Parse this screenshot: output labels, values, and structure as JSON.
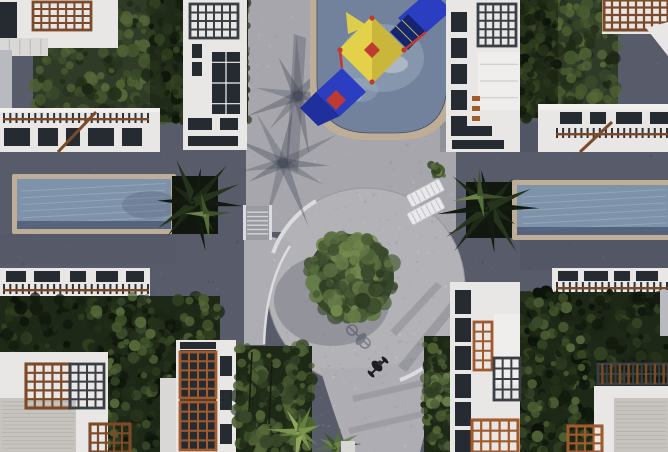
{
  "scene": {
    "title": "Aerial top-down 3D render of a residential complex courtyard",
    "view": "top-down",
    "landmarks": [
      "kids pool with playground slide",
      "left lap pool",
      "right lap pool",
      "central circular plaza",
      "round courtyard tree",
      "curved pedestrian path",
      "cyclist on path",
      "white apartment buildings with wooden pergolas",
      "green hedges, gardens and palm trees",
      "lounge chairs and stairs at pool deck"
    ]
  },
  "colors": {
    "paving_dark": "#585c6a",
    "walkway_light": "#a6a6ac",
    "plaza_light": "#b3b2b6",
    "path_light": "#aeadb3",
    "curb_white": "#dcdbdd",
    "stair_tread": "#9a9aa2",
    "step_line": "#b9b8b6",
    "plaza_rim": "#97979f",
    "shadow_blue": "#3e4354",
    "pool_water": "#7e92aa",
    "kids_pool_water": "#73829c",
    "pool_border_tan": "#bfae97",
    "pool_edge_shadow": "#46506a",
    "ripple_light": "#aabdce",
    "planter_dark": "#11160f",
    "building_white": "#e8e7e5",
    "building_dim": "#d9d8d6",
    "roof_light": "#f1f0ee",
    "roof_concrete": "#c7c4c0",
    "roof_grain": "#8f8c88",
    "wall_gray": "#b9bac0",
    "court_white": "#efeeec",
    "window_dark": "#262b31",
    "window_frame": "#eef0f2",
    "pergola_brown": "#7c4a28",
    "pergola_orange": "#a05a2c",
    "pergola_dark": "#3a3e45",
    "fence_dark": "#2e3236",
    "hedge_top_base": "#2f3b26",
    "hedge_dark_base": "#1e2817",
    "hedge_shade": "#101708",
    "tree_base": "#36452a",
    "trunk_dark": "#151b10",
    "grid_rail_gray": "#9aa0a8",
    "canopy_yellow": "#e3d149",
    "canopy_shade": "#c9b63a",
    "slide_blue": "#2b3dc0",
    "slide_blue_dark": "#202f9e",
    "net_navy": "#15246e",
    "net_line": "#d8d84e",
    "frame_red": "#bf3a30",
    "splash_white": "#cfd8e2",
    "chair_white": "#e9e9eb",
    "chair_slat": "#bfbfc6",
    "pot_white": "#d8d7d5",
    "bike_dark": "#1d1d22",
    "bush_green": "#4a5c31",
    "palettes": {
      "noisePaving": [
        "rgba(255,255,255,0.05)",
        "rgba(0,0,0,0.09)",
        "rgba(185,195,212,0.06)"
      ],
      "noiseLight": [
        "rgba(70,74,88,0.10)",
        "rgba(255,255,255,0.12)",
        "rgba(120,120,135,0.08)"
      ],
      "hedge": [
        "#243019",
        "#38482a",
        "#46592f",
        "#56683a",
        "#1c2614",
        "#4f6234"
      ],
      "hedgeDark": [
        "#121a0e",
        "#1c2615",
        "#26321b",
        "#324222",
        "#0d130a"
      ],
      "treeGreen": [
        "#3a4a2c",
        "#4b5d36",
        "#5a6f40",
        "#667c49",
        "#2f3d22",
        "#74894f"
      ],
      "palmDark": [
        "#131a10",
        "#1d2816",
        "#27341d"
      ],
      "palmMid": [
        "#3f522c",
        "#55703c",
        "#6d8449"
      ],
      "palmBright": [
        "#4e6a33",
        "#62803e",
        "#7d9450",
        "#93a55e"
      ],
      "shadowPalm": [
        "rgba(62,67,84,0.36)",
        "rgba(62,67,84,0.28)"
      ]
    }
  }
}
